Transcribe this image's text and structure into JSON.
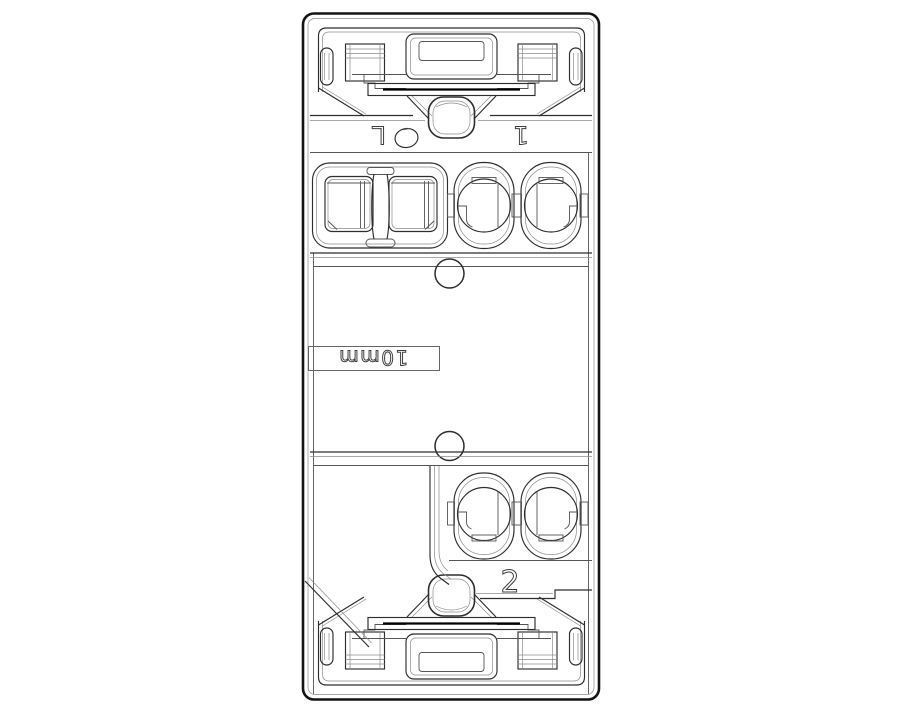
{
  "drawing": {
    "kind": "technical-line-drawing",
    "background_color": "#ffffff",
    "outline_color": "#141414",
    "detail_line_color": "#2e2e2e",
    "light_line_color": "#8c8c8c",
    "marking_color": "#3f3f3f",
    "markings": {
      "terminal_line": "L",
      "terminal_top": "1",
      "terminal_bottom": "2",
      "strip_length": "10mm"
    }
  }
}
